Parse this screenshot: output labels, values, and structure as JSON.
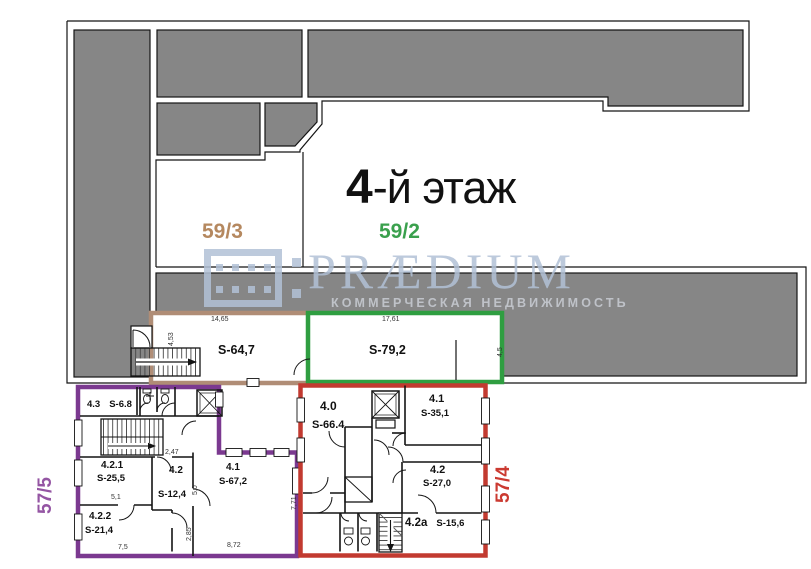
{
  "plan": {
    "floor_title": {
      "number": "4",
      "suffix": "-й этаж"
    },
    "sections": {
      "s59_3": "59/3",
      "s59_2": "59/2",
      "s57_5": "57/5",
      "s57_4": "57/4"
    },
    "watermark": {
      "brand": "PRÆDIUM",
      "tagline": "КОММЕРЧЕСКАЯ НЕДВИЖИМОСТЬ"
    },
    "units": {
      "tan_unit": {
        "area": "S-64,7",
        "dim_top": "14,65",
        "dim_left": "4,53"
      },
      "green_unit": {
        "area": "S-79,2",
        "dim_top": "17,61",
        "dim_right": "4,5"
      },
      "purple_block": {
        "r43_num": "4.3",
        "r43_area": "S-6.8",
        "r421_num": "4.2.1",
        "r421_area": "S-25,5",
        "r421_dim": "5,1",
        "r42_num": "4.2",
        "r42_area": "S-12,4",
        "r42_dim_top": "2,47",
        "r42_dim_right": "5,0",
        "r41_num": "4.1",
        "r41_area": "S-67,2",
        "r41_dim_bottom": "8,72",
        "r41_dim_right": "7,71",
        "r422_num": "4.2.2",
        "r422_area": "S-21,4",
        "r422_dim_bottom": "7,5",
        "r422_dim_right": "2,85"
      },
      "red_block": {
        "r40_num": "4.0",
        "r40_area": "S-66.4",
        "r41_num": "4.1",
        "r41_area": "S-35,1",
        "r42_num": "4.2",
        "r42_area": "S-27,0",
        "r42a_num": "4.2a",
        "r42a_area": "S-15,6"
      }
    },
    "colors": {
      "gray_mass": "#868686",
      "tan": "#b08d76",
      "green": "#2f9e41",
      "purple": "#7b3990",
      "red": "#c23a30",
      "label_tan": "#b5885f",
      "label_green": "#3aa04d",
      "label_purple": "#9455a3",
      "label_red": "#cb3a31",
      "watermark_blue": "#b2c1d6",
      "watermark_gray": "#c9cdd4"
    }
  }
}
